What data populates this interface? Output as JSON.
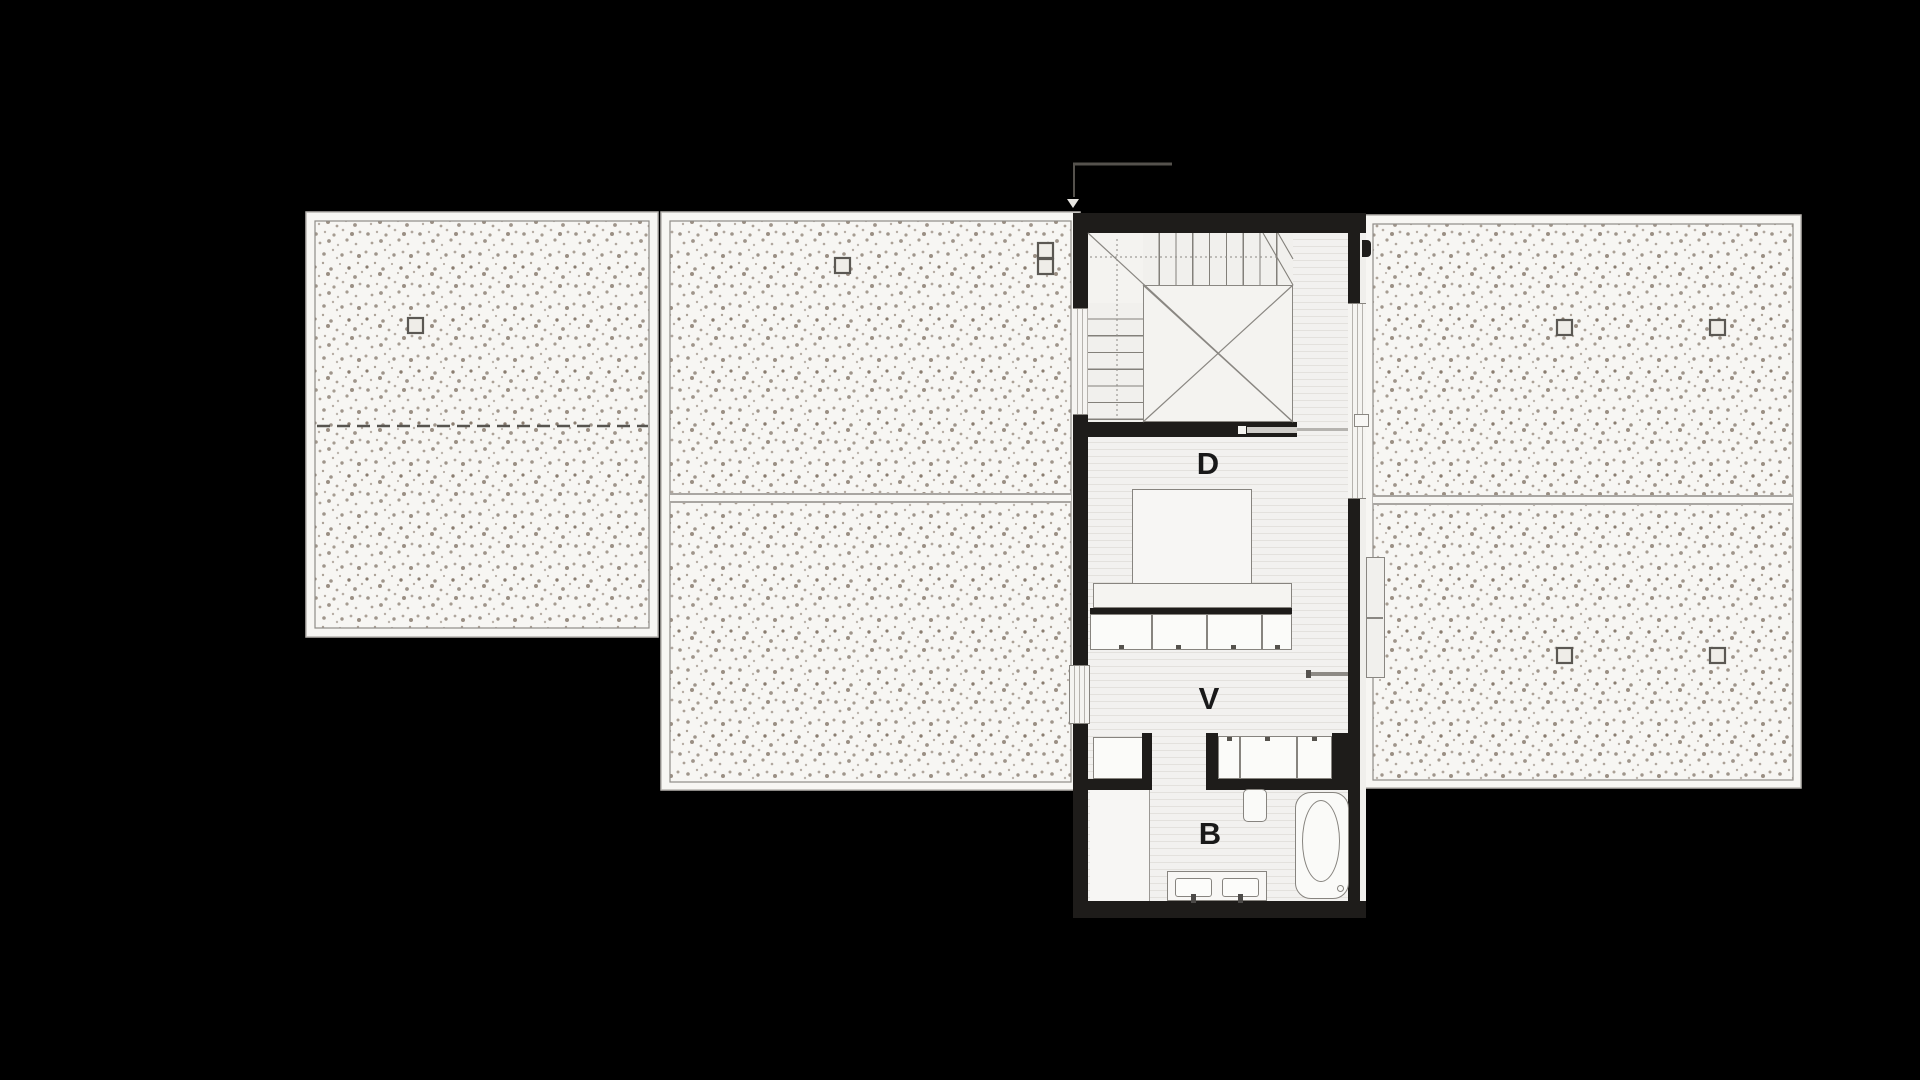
{
  "plan": {
    "type": "architectural floor plan",
    "labels": {
      "room_d": "D",
      "room_v": "V",
      "room_b": "B"
    },
    "elements": [
      "roof-panel-left",
      "roof-panel-middle",
      "roof-panel-right",
      "staircase-with-void",
      "bed",
      "bed-platform",
      "wardrobe-row",
      "closet-left",
      "closet-right",
      "wall-shelf",
      "toilet",
      "bathtub",
      "vanity-double-sink",
      "shower-area",
      "sliding-door",
      "section-cut-marker",
      "skylight-markers",
      "west-window",
      "east-window",
      "exterior-door-panel"
    ],
    "roof_markers_count": 8
  },
  "theme": {
    "background": "#000000",
    "paper": "#f7f6f3",
    "floor": "#f2f1ef",
    "floor_line": "#e3e1dd",
    "wall": "#1e1c1a",
    "line_mid": "#87847f",
    "line_dark": "#55524d",
    "stipple": "#8a7d70",
    "label_color": "#191919",
    "white_fill": "#fbfbf9"
  }
}
